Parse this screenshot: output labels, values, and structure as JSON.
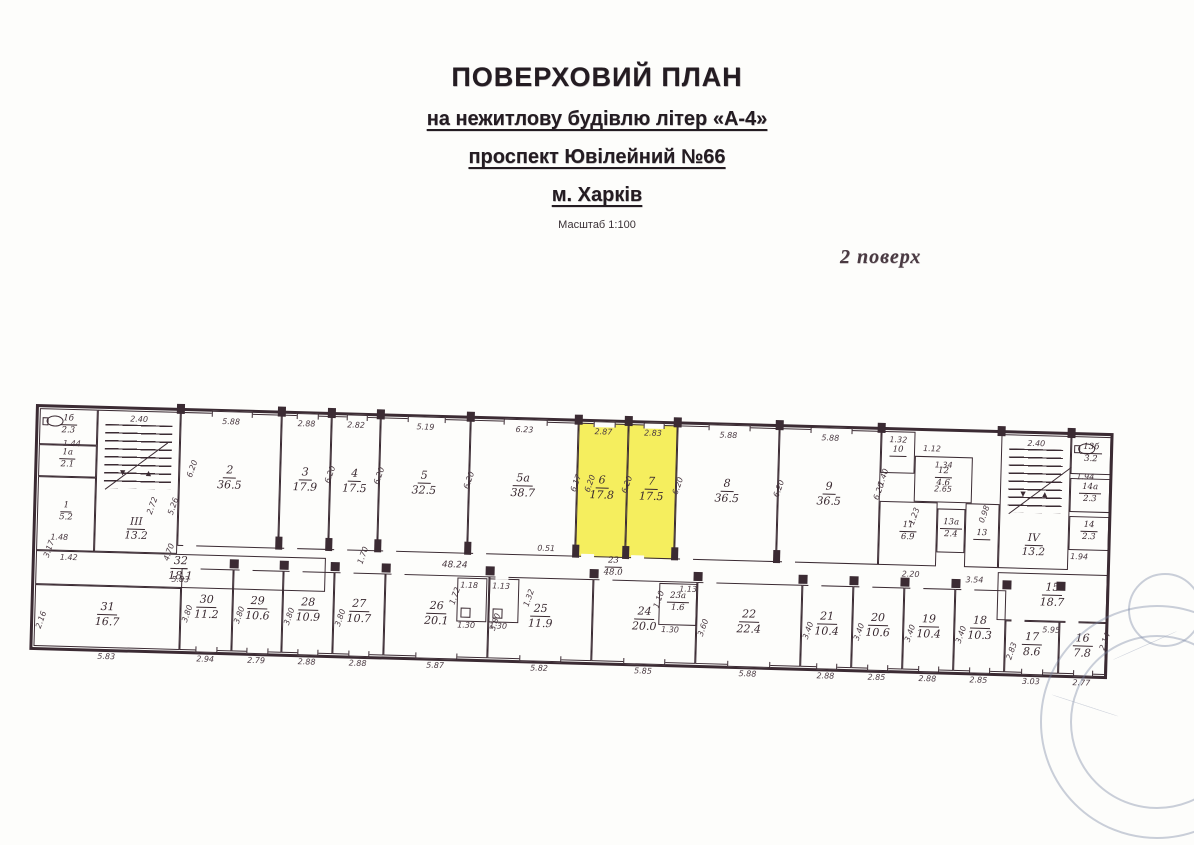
{
  "title": {
    "line1": "ПОВЕРХОВИЙ ПЛАН",
    "line2": "на нежитлову будівлю літер «А-4»",
    "line3": "проспект Ювілейний №66",
    "line4": "м. Харків",
    "scale": "Масштаб 1:100",
    "floor_note": "2 поверх"
  },
  "colors": {
    "ink": "#3b2b33",
    "highlight": "#f5ee5e",
    "stamp": "#7482a0"
  },
  "plan": {
    "rooms": [
      {
        "id": "1b",
        "num": "1б",
        "area": "2.3",
        "x": 4,
        "y": 4,
        "w": 58,
        "h": 36,
        "s": 1,
        "wc": 1
      },
      {
        "id": "1a",
        "num": "1а",
        "area": "2.1",
        "x": 4,
        "y": 40,
        "w": 58,
        "h": 32,
        "s": 1
      },
      {
        "id": "1",
        "num": "1",
        "area": "5.2",
        "x": 4,
        "y": 72,
        "w": 58,
        "h": 74,
        "s": 1
      },
      {
        "id": "32",
        "num": "32",
        "area": "18.1",
        "x": 4,
        "y": 146,
        "w": 290,
        "h": 34,
        "sub_dim": "5.83"
      },
      {
        "id": "31",
        "num": "31",
        "area": "16.7",
        "x": 4,
        "y": 180,
        "w": 146,
        "h": 62,
        "bottom_dim": "5.83",
        "side_dim": "2.16"
      },
      {
        "id": "2",
        "num": "2",
        "area": "36.5",
        "x": 145,
        "y": 4,
        "w": 101,
        "h": 134,
        "top_dim": "5.88",
        "win": 1,
        "doorb": 1
      },
      {
        "id": "3",
        "num": "3",
        "area": "17.9",
        "x": 246,
        "y": 4,
        "w": 50,
        "h": 134,
        "top_dim": "2.88",
        "win": 1,
        "doorb": 1
      },
      {
        "id": "4",
        "num": "4",
        "area": "17.5",
        "x": 296,
        "y": 4,
        "w": 49,
        "h": 134,
        "top_dim": "2.82",
        "win": 1,
        "doorb": 1
      },
      {
        "id": "5",
        "num": "5",
        "area": "32.5",
        "x": 345,
        "y": 4,
        "w": 90,
        "h": 134,
        "top_dim": "5.19",
        "win": 1,
        "doorb": 1
      },
      {
        "id": "5a",
        "num": "5а",
        "area": "38.7",
        "x": 435,
        "y": 4,
        "w": 108,
        "h": 134,
        "top_dim": "6.23",
        "win": 1,
        "doorb": 1
      },
      {
        "id": "6",
        "num": "6",
        "area": "17.8",
        "x": 543,
        "y": 4,
        "w": 50,
        "h": 134,
        "top_dim": "2.87",
        "hl": 1,
        "win": 1,
        "doorb": 1
      },
      {
        "id": "7",
        "num": "7",
        "area": "17.5",
        "x": 593,
        "y": 4,
        "w": 49,
        "h": 134,
        "top_dim": "2.83",
        "hl": 1,
        "win": 1,
        "doorb": 1
      },
      {
        "id": "8",
        "num": "8",
        "area": "36.5",
        "x": 642,
        "y": 4,
        "w": 102,
        "h": 134,
        "top_dim": "5.88",
        "win": 1,
        "doorb": 1
      },
      {
        "id": "9",
        "num": "9",
        "area": "36.5",
        "x": 744,
        "y": 4,
        "w": 102,
        "h": 134,
        "top_dim": "5.88",
        "win": 1,
        "doorb": 1
      },
      {
        "id": "10",
        "num": "10",
        "area": "",
        "x": 846,
        "y": 4,
        "w": 34,
        "h": 42,
        "top_dim": "1.32",
        "s": 1
      },
      {
        "id": "12",
        "num": "12",
        "area": "4.6",
        "x": 880,
        "y": 28,
        "w": 58,
        "h": 46,
        "top_dim": "1.34",
        "s": 1,
        "sub_dim": "2.65"
      },
      {
        "id": "11",
        "num": "11",
        "area": "6.9",
        "x": 846,
        "y": 74,
        "w": 58,
        "h": 64,
        "s": 1
      },
      {
        "id": "13a",
        "num": "13а",
        "area": "2.4",
        "x": 904,
        "y": 80,
        "w": 28,
        "h": 44,
        "s": 1
      },
      {
        "id": "13",
        "num": "13",
        "area": "",
        "x": 932,
        "y": 74,
        "w": 34,
        "h": 64,
        "s": 1
      },
      {
        "id": "13b",
        "num": "13б",
        "area": "3.2",
        "x": 1036,
        "y": 4,
        "w": 40,
        "h": 38,
        "s": 1,
        "wc": 1
      },
      {
        "id": "14a",
        "num": "14а",
        "area": "2.3",
        "x": 1036,
        "y": 46,
        "w": 40,
        "h": 34,
        "s": 1
      },
      {
        "id": "14",
        "num": "14",
        "area": "2.3",
        "x": 1036,
        "y": 84,
        "w": 40,
        "h": 34,
        "s": 1
      },
      {
        "id": "15",
        "num": "15",
        "area": "18.7",
        "x": 966,
        "y": 142,
        "w": 110,
        "h": 48,
        "bottom_dim": "5.95"
      },
      {
        "id": "30",
        "num": "30",
        "area": "11.2",
        "x": 150,
        "y": 160,
        "w": 52,
        "h": 82,
        "bottom_dim": "2.94",
        "side_dim": "3.80",
        "doort": 1,
        "winb": 1
      },
      {
        "id": "29",
        "num": "29",
        "area": "10.6",
        "x": 202,
        "y": 160,
        "w": 50,
        "h": 82,
        "bottom_dim": "2.79",
        "side_dim": "3.80",
        "doort": 1,
        "winb": 1
      },
      {
        "id": "28",
        "num": "28",
        "area": "10.9",
        "x": 252,
        "y": 160,
        "w": 51,
        "h": 82,
        "bottom_dim": "2.88",
        "side_dim": "3.80",
        "doort": 1,
        "winb": 1
      },
      {
        "id": "27",
        "num": "27",
        "area": "10.7",
        "x": 303,
        "y": 160,
        "w": 51,
        "h": 82,
        "bottom_dim": "2.88",
        "side_dim": "3.80",
        "doort": 1,
        "winb": 1
      },
      {
        "id": "26",
        "num": "26",
        "area": "20.1",
        "x": 354,
        "y": 160,
        "w": 104,
        "h": 82,
        "bottom_dim": "5.87",
        "doort": 1,
        "winb": 1
      },
      {
        "id": "25",
        "num": "25",
        "area": "11.9",
        "x": 458,
        "y": 160,
        "w": 104,
        "h": 82,
        "bottom_dim": "5.82",
        "side_dim": "3.80",
        "doort": 1,
        "winb": 1
      },
      {
        "id": "24",
        "num": "24",
        "area": "20.0",
        "x": 562,
        "y": 160,
        "w": 104,
        "h": 82,
        "bottom_dim": "5.85",
        "doort": 1,
        "winb": 1
      },
      {
        "id": "23a",
        "num": "23а",
        "area": "1.6",
        "x": 628,
        "y": 162,
        "w": 38,
        "h": 42,
        "s": 1
      },
      {
        "id": "22",
        "num": "22",
        "area": "22.4",
        "x": 666,
        "y": 160,
        "w": 105,
        "h": 82,
        "bottom_dim": "5.88",
        "side_dim": "3.60",
        "doort": 1,
        "winb": 1
      },
      {
        "id": "21",
        "num": "21",
        "area": "10.4",
        "x": 771,
        "y": 160,
        "w": 51,
        "h": 82,
        "bottom_dim": "2.88",
        "side_dim": "3.40",
        "doort": 1,
        "winb": 1
      },
      {
        "id": "20",
        "num": "20",
        "area": "10.6",
        "x": 822,
        "y": 160,
        "w": 51,
        "h": 82,
        "bottom_dim": "2.85",
        "side_dim": "3.40",
        "doort": 1,
        "winb": 1
      },
      {
        "id": "19",
        "num": "19",
        "area": "10.4",
        "x": 873,
        "y": 160,
        "w": 51,
        "h": 82,
        "bottom_dim": "2.88",
        "side_dim": "3.40",
        "doort": 1,
        "winb": 1
      },
      {
        "id": "18",
        "num": "18",
        "area": "10.3",
        "x": 924,
        "y": 160,
        "w": 51,
        "h": 82,
        "bottom_dim": "2.85",
        "side_dim": "3.40",
        "doort": 1,
        "winb": 1
      },
      {
        "id": "17",
        "num": "17",
        "area": "8.6",
        "x": 975,
        "y": 190,
        "w": 54,
        "h": 52,
        "bottom_dim": "3.03",
        "side_dim": "2.83",
        "doort": 1,
        "winb": 1
      },
      {
        "id": "16",
        "num": "16",
        "area": "7.8",
        "x": 1029,
        "y": 190,
        "w": 47,
        "h": 52,
        "bottom_dim": "2.77",
        "doort": 1,
        "winb": 1
      }
    ],
    "stairs": [
      {
        "id": "stairwell-3",
        "label": "III",
        "area": "13.2",
        "x": 62,
        "y": 4,
        "w": 83,
        "h": 142,
        "top_dim": "2.40"
      },
      {
        "id": "stairwell-4",
        "label": "IV",
        "area": "13.2",
        "x": 966,
        "y": 4,
        "w": 70,
        "h": 134,
        "top_dim": "2.40"
      }
    ],
    "cells": [
      {
        "x": 426,
        "y": 162,
        "w": 30,
        "h": 44
      },
      {
        "x": 458,
        "y": 162,
        "w": 30,
        "h": 44
      }
    ],
    "corridor": {
      "num": "23",
      "area": "48.0",
      "x": 572,
      "y": 136,
      "length_dim": "48.24",
      "dim_x": 410,
      "dim_y": 145
    },
    "dims": [
      {
        "t": "6.20",
        "x": 149,
        "y": 56,
        "r": -72
      },
      {
        "t": "6.20",
        "x": 287,
        "y": 58,
        "r": -72
      },
      {
        "t": "6.20",
        "x": 336,
        "y": 58,
        "r": -72
      },
      {
        "t": "6.20",
        "x": 426,
        "y": 60,
        "r": -72
      },
      {
        "t": "6.17",
        "x": 533,
        "y": 60,
        "r": -72
      },
      {
        "t": "6.20",
        "x": 547,
        "y": 60,
        "r": -72
      },
      {
        "t": "6.20",
        "x": 584,
        "y": 60,
        "r": -72
      },
      {
        "t": "6.20",
        "x": 635,
        "y": 60,
        "r": -72
      },
      {
        "t": "6.20",
        "x": 736,
        "y": 60,
        "r": -72
      },
      {
        "t": "6.20",
        "x": 836,
        "y": 60,
        "r": -72
      },
      {
        "t": "3.17",
        "x": 8,
        "y": 140,
        "r": -72
      },
      {
        "t": "4.70",
        "x": 128,
        "y": 140,
        "r": -72
      },
      {
        "t": "1.70",
        "x": 322,
        "y": 138,
        "r": -72
      },
      {
        "t": "2.72",
        "x": 110,
        "y": 94,
        "r": -72
      },
      {
        "t": "5.26",
        "x": 131,
        "y": 94,
        "r": -72
      },
      {
        "t": "1.44",
        "x": 28,
        "y": 34,
        "r": 0
      },
      {
        "t": "1.48",
        "x": 18,
        "y": 128,
        "r": 0
      },
      {
        "t": "1.42",
        "x": 28,
        "y": 148,
        "r": 0
      },
      {
        "t": "0.51",
        "x": 505,
        "y": 126,
        "r": 0
      },
      {
        "t": "1.40",
        "x": 840,
        "y": 46,
        "r": -72
      },
      {
        "t": "1.12",
        "x": 888,
        "y": 16,
        "r": 0
      },
      {
        "t": "1.23",
        "x": 872,
        "y": 84,
        "r": -72
      },
      {
        "t": "0.98",
        "x": 942,
        "y": 80,
        "r": -72
      },
      {
        "t": "2.20",
        "x": 870,
        "y": 142,
        "r": 0
      },
      {
        "t": "3.54",
        "x": 934,
        "y": 146,
        "r": 0
      },
      {
        "t": "1.94",
        "x": 1042,
        "y": 40,
        "r": 0
      },
      {
        "t": "1.94",
        "x": 1038,
        "y": 120,
        "r": 0
      },
      {
        "t": "2.14",
        "x": 1066,
        "y": 204,
        "r": -72
      },
      {
        "t": "1.18",
        "x": 429,
        "y": 165,
        "r": 0
      },
      {
        "t": "1.13",
        "x": 461,
        "y": 165,
        "r": 0
      },
      {
        "t": "1.30",
        "x": 427,
        "y": 205,
        "r": 0
      },
      {
        "t": "1.30",
        "x": 459,
        "y": 205,
        "r": 0
      },
      {
        "t": "1.72",
        "x": 415,
        "y": 176,
        "r": -72
      },
      {
        "t": "1.32",
        "x": 489,
        "y": 176,
        "r": -72
      },
      {
        "t": "1.13",
        "x": 648,
        "y": 163,
        "r": 0
      },
      {
        "t": "1.30",
        "x": 631,
        "y": 204,
        "r": 0
      },
      {
        "t": "1.10",
        "x": 619,
        "y": 174,
        "r": -72
      }
    ],
    "piers_top": [
      145,
      246,
      296,
      345,
      435,
      543,
      593,
      642,
      744,
      846,
      966,
      1036
    ],
    "piers_mid": [
      246,
      296,
      345,
      435,
      543,
      593,
      642,
      744
    ],
    "piers_low": [
      202,
      252,
      303,
      354,
      458,
      562,
      666,
      771,
      822,
      873,
      924,
      975,
      1029
    ]
  }
}
